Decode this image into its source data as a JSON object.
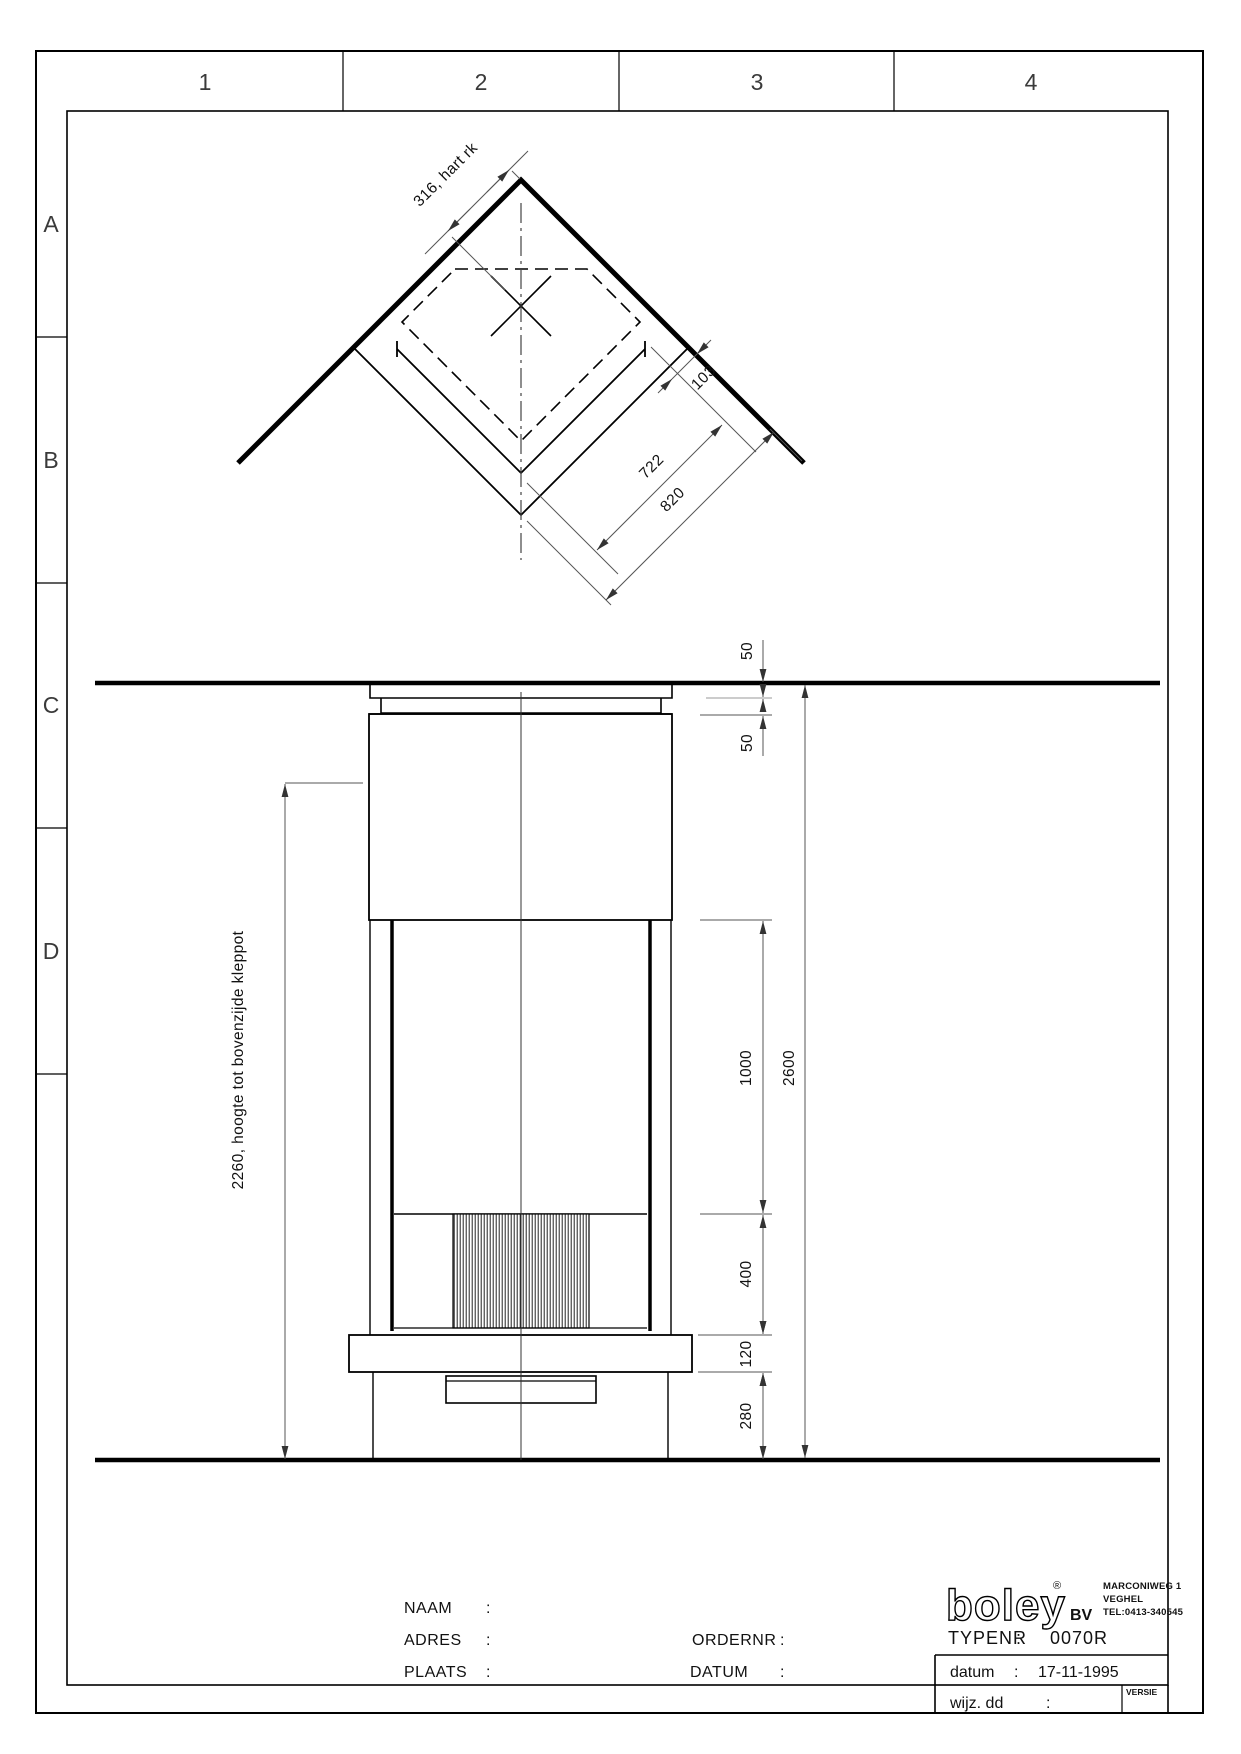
{
  "frame": {
    "columns": [
      "1",
      "2",
      "3",
      "4"
    ],
    "rows": [
      "A",
      "B",
      "C",
      "D"
    ]
  },
  "top_view": {
    "dim_hart_rk": "316, hart rk",
    "dim_gap": "103",
    "dim_inner": "722",
    "dim_outer": "820"
  },
  "elevation": {
    "dim_ceiling_gap": "50",
    "dim_collar": "50",
    "dim_shaft": "1000",
    "dim_total": "2600",
    "dim_grille": "400",
    "dim_plate": "120",
    "dim_base": "280",
    "dim_height_note": "2260, hoogte tot bovenzijde kleppot"
  },
  "title_block": {
    "colon": ":",
    "naam_label": "NAAM",
    "adres_label": "ADRES",
    "plaats_label": "PLAATS",
    "ordernr_label": "ORDERNR",
    "datum_label": "DATUM",
    "logo_text": "boley",
    "logo_reg": "®",
    "logo_suffix": "BV",
    "address": [
      "MARCONIWEG 1",
      "VEGHEL",
      "TEL:0413-340545"
    ],
    "typenr_label": "TYPENR",
    "typenr_value": "0070R",
    "date_label": "datum",
    "date_value": "17-11-1995",
    "revision_label": "wijz. dd",
    "versie_label": "VERSIE"
  }
}
